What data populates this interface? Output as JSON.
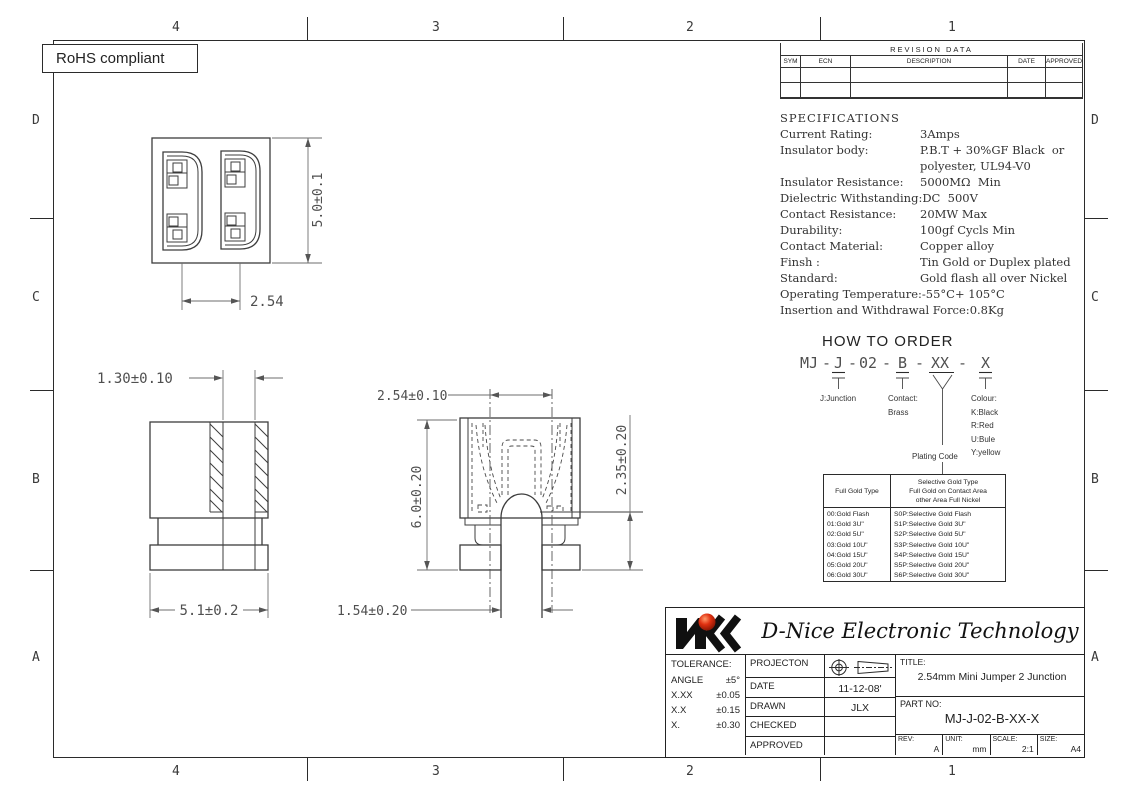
{
  "frame": {
    "rohs_label": "RoHS compliant",
    "zone_cols_top": [
      "4",
      "3",
      "2",
      "1"
    ],
    "zone_cols_bottom": [
      "4",
      "3",
      "2",
      "1"
    ],
    "zone_rows_left": [
      "D",
      "C",
      "B",
      "A"
    ],
    "zone_rows_right": [
      "D",
      "C",
      "B",
      "A"
    ]
  },
  "revision_table": {
    "title": "REVISION DATA",
    "headers": [
      "SYM",
      "ECN",
      "DESCRIPTION",
      "DATE",
      "APPROVED"
    ]
  },
  "specifications": {
    "title": "SPECIFICATIONS",
    "items": [
      {
        "label": "Current Rating:",
        "value": "3Amps"
      },
      {
        "label": "Insulator body:",
        "value": "P.B.T + 30%GF Black  or"
      },
      {
        "label": "",
        "value": "polyester, UL94-V0"
      },
      {
        "label": "Insulator Resistance:",
        "value": "5000MΩ  Min"
      },
      {
        "label": "Dielectric Withstanding:",
        "value": "DC  500V"
      },
      {
        "label": "Contact Resistance:",
        "value": "20MW Max"
      },
      {
        "label": "Durability:",
        "value": "100gf Cycls Min"
      },
      {
        "label": "Contact Material:",
        "value": "Copper alloy"
      },
      {
        "label": "Finsh :",
        "value": "Tin Gold or Duplex plated"
      },
      {
        "label": "Standard:",
        "value": "Gold flash all over Nickel"
      },
      {
        "label": "Operating Temperature:",
        "value": "-55°C+ 105°C"
      },
      {
        "label": "Insertion and Withdrawal Force:",
        "value": "0.8Kg"
      }
    ]
  },
  "how_to_order": {
    "title": "HOW TO ORDER",
    "code": {
      "p1": "MJ",
      "d1": "-",
      "p2": "J",
      "d2": "-",
      "p3": "02",
      "d3": "-",
      "p4": "B",
      "d4": "-",
      "p5": "XX",
      "d5": "-",
      "p6": "X"
    },
    "junction_note": "J:Junction",
    "contact_note_1": "Contact:",
    "contact_note_2": "Brass",
    "colour_title": "Colour:",
    "colour_options": [
      "K:Black",
      "R:Red",
      "U:Bule",
      "Y:yellow"
    ],
    "plating_code_label": "Plating Code"
  },
  "plating_table": {
    "full_header": "Full Gold Type",
    "selective_header_lines": [
      "Selective Gold Type",
      "Full Gold on Contact Area",
      "other Area Full Nickel"
    ],
    "full_rows": [
      "00:Gold Flash",
      "01:Gold 3U\"",
      "02:Gold 5U\"",
      "03:Gold 10U\"",
      "04:Gold 15U\"",
      "05:Gold 20U\"",
      "06:Gold 30U\""
    ],
    "selective_rows": [
      "S0P:Selective Gold Flash",
      "S1P:Selective Gold 3U\"",
      "S2P:Selective Gold 5U\"",
      "S3P:Selective Gold 10U\"",
      "S4P:Selective Gold 15U\"",
      "S5P:Selective Gold 20U\"",
      "S6P:Selective Gold 30U\""
    ]
  },
  "dimensions": {
    "top_view": {
      "height": "5.0±0.1",
      "pitch": "2.54"
    },
    "side_view": {
      "wall": "1.30±0.10",
      "width": "5.1±0.2"
    },
    "front_view": {
      "pitch": "2.54±0.10",
      "height": "6.0±0.20",
      "lower": "2.35±0.20",
      "pin": "1.54±0.20"
    }
  },
  "title_block": {
    "company": "D-Nice Electronic Technology",
    "tolerance_title": "TOLERANCE:",
    "tolerances": [
      {
        "label": "ANGLE",
        "value": "±5°"
      },
      {
        "label": "X.XX",
        "value": "±0.05"
      },
      {
        "label": "X.X",
        "value": "±0.15"
      },
      {
        "label": "X.",
        "value": "±0.30"
      }
    ],
    "fields": [
      {
        "label": "PROJECTON",
        "value": ""
      },
      {
        "label": "DATE",
        "value": "11-12-08'"
      },
      {
        "label": "DRAWN",
        "value": "JLX"
      },
      {
        "label": "CHECKED",
        "value": ""
      },
      {
        "label": "APPROVED",
        "value": ""
      }
    ],
    "title_label": "TITLE:",
    "title": "2.54mm Mini Jumper 2 Junction",
    "part_label": "PART  NO:",
    "part_no": "MJ-J-02-B-XX-X",
    "rev_label": "REV:",
    "rev": "A",
    "unit_label": "UNIT:",
    "unit": "mm",
    "scale_label": "SCALE:",
    "scale": "2:1",
    "size_label": "SIZE:",
    "size": "A4"
  },
  "colors": {
    "line": "#2b2b2b",
    "dim_text": "#4f4f4f",
    "logo_red": "#e03010"
  }
}
